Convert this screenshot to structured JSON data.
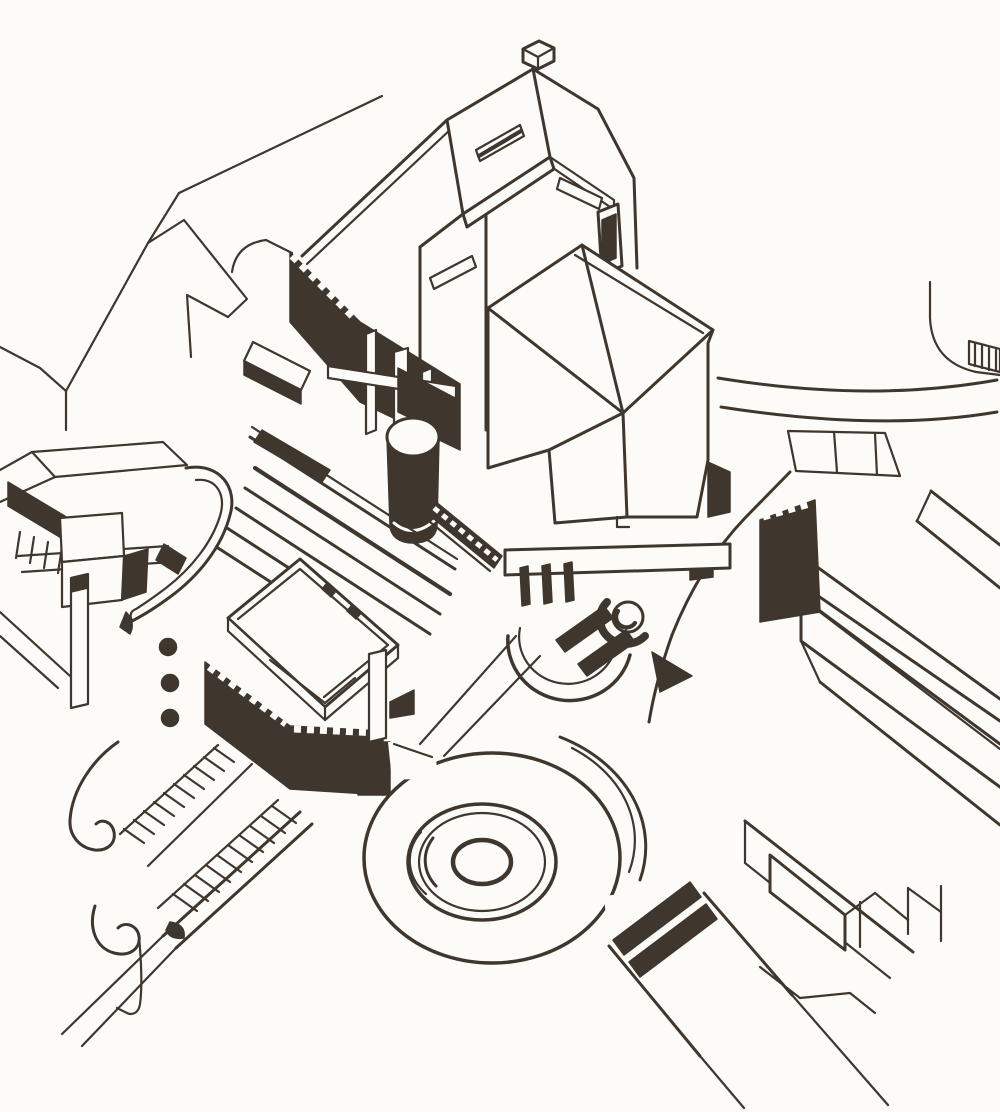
{
  "drawing": {
    "title": "Axonometric site drawing of a civic centre",
    "description": "Black-and-white ink axonometric architectural drawing on white paper showing a civic complex: a tall gabled tower with slot windows, a hexagonal pavilion, a dark cylindrical tower, terraced steps, a box building on a dark arcaded base, curved ramp buildings with porthole windows, long slab buildings, a circular plaza of concentric rings, hatched exterior stairs, pedestrian crossings and radiating roads.",
    "style": "scanned ink line drawing, no text"
  },
  "colors": {
    "ink": "#3f362e",
    "paper": "#fcfbf8"
  },
  "elements": {
    "streets_top_left": "faint street and roof outlines, top left",
    "ring_road": "curved ring road with pedestrian crossing, top right",
    "hatched_block": "small hatched service block at right edge",
    "dentil_wall_right": "dark arcaded wall with dentil top, right of centre",
    "slab_buildings": "long low slab buildings, right and bottom right",
    "tower": "tall gabled tower with rooftop monitor and slot windows",
    "fin_wall": "dark wall with white pilaster fins and beam",
    "hexagon_pavilion": "hexagonal pavilion with hipped roof",
    "stage_apse": "semicircular apse with spiral stair and slot openings",
    "cylinder_tower": "dark cylindrical stair tower",
    "terraces": "long terraced steps",
    "left_wing": "left wing: bars, box building, curved ramp, portholes, pier",
    "box_on_base": "box building on dark dentil base",
    "grand_stairs": "hatched outdoor stair bands with kerbs",
    "hooked_paths": "curved hook-ended footpaths, bottom left",
    "circular_plaza": "circular plaza of concentric rings",
    "crosswalk_road": "south-east road with two dark crossing bands"
  }
}
